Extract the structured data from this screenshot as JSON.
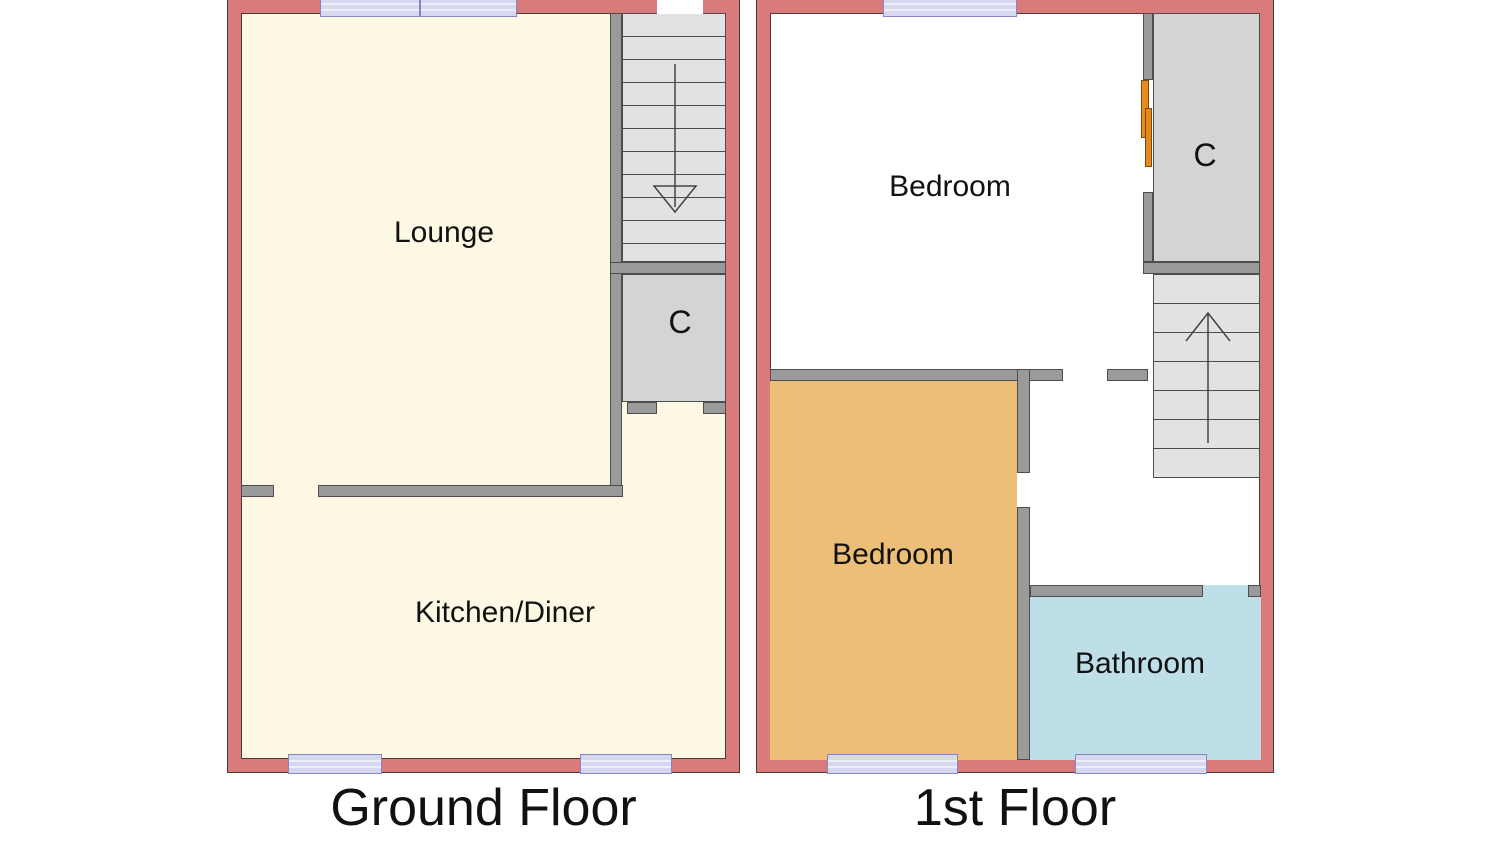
{
  "colors": {
    "outer_wall": "#DB7A7A",
    "inner_wall": "#9A9A9A",
    "wall_outline": "#4A3A3A",
    "cream": "#FDF8E3",
    "closet": "#D4D4D4",
    "stairs": "#E2E2E2",
    "bedroom2": "#ECBE78",
    "bathroom": "#BFDFE8",
    "window_fill": "#D6D8F0",
    "window_border": "#8585C2",
    "door": "#E8891D"
  },
  "ground_floor": {
    "title": "Ground Floor",
    "rooms": {
      "lounge": "Lounge",
      "kitchen": "Kitchen/Diner",
      "closet": "C"
    }
  },
  "first_floor": {
    "title": "1st Floor",
    "rooms": {
      "bedroom_front": "Bedroom",
      "bedroom_back": "Bedroom",
      "bathroom": "Bathroom",
      "closet": "C"
    }
  }
}
